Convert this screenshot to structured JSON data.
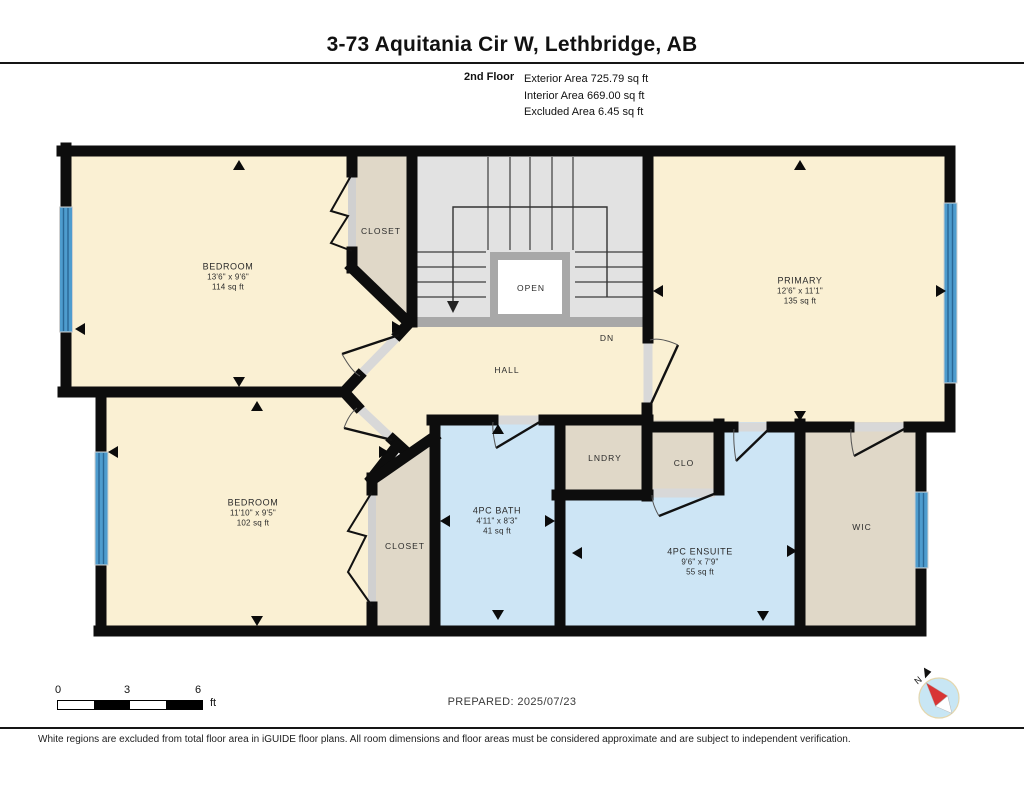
{
  "header": {
    "title": "3-73 Aquitania Cir W, Lethbridge, AB",
    "floor_label": "2nd Floor",
    "area_lines": [
      "Exterior Area 725.79 sq ft",
      "Interior Area 669.00 sq ft",
      "Excluded Area 6.45 sq ft"
    ]
  },
  "rooms": {
    "bedroom1": {
      "name": "BEDROOM",
      "dims": "13'6\" x 9'6\"",
      "area": "114 sq ft"
    },
    "primary": {
      "name": "PRIMARY",
      "dims": "12'6\" x 11'1\"",
      "area": "135 sq ft"
    },
    "bedroom2": {
      "name": "BEDROOM",
      "dims": "11'10\" x 9'5\"",
      "area": "102 sq ft"
    },
    "bath": {
      "name": "4PC BATH",
      "dims": "4'11\" x 8'3\"",
      "area": "41 sq ft"
    },
    "ensuite": {
      "name": "4PC ENSUITE",
      "dims": "9'6\" x 7'9\"",
      "area": "55 sq ft"
    },
    "closet_top": "CLOSET",
    "closet_bottom": "CLOSET",
    "hall": "HALL",
    "open": "OPEN",
    "dn": "DN",
    "lndry": "LNDRY",
    "clo": "CLO",
    "wic": "WIC"
  },
  "footer": {
    "scale": {
      "tick0": "0",
      "tick3": "3",
      "tick6": "6",
      "unit": "ft"
    },
    "prepared": "PREPARED: 2025/07/23",
    "compass_north": "N"
  },
  "disclaimer": "White regions are excluded from total floor area in iGUIDE floor plans. All room dimensions and floor areas must be considered approximate and are subject to independent verification.",
  "colors": {
    "wall": "#0d0d0d",
    "room_cream": "#FAF0D3",
    "closet_beige": "#E0D8C8",
    "bath_blue": "#CDE5F5",
    "stair_gray": "#E2E2E2",
    "stair_border_gray": "#A8A8A8",
    "window_blue": "#4E9CCE"
  }
}
